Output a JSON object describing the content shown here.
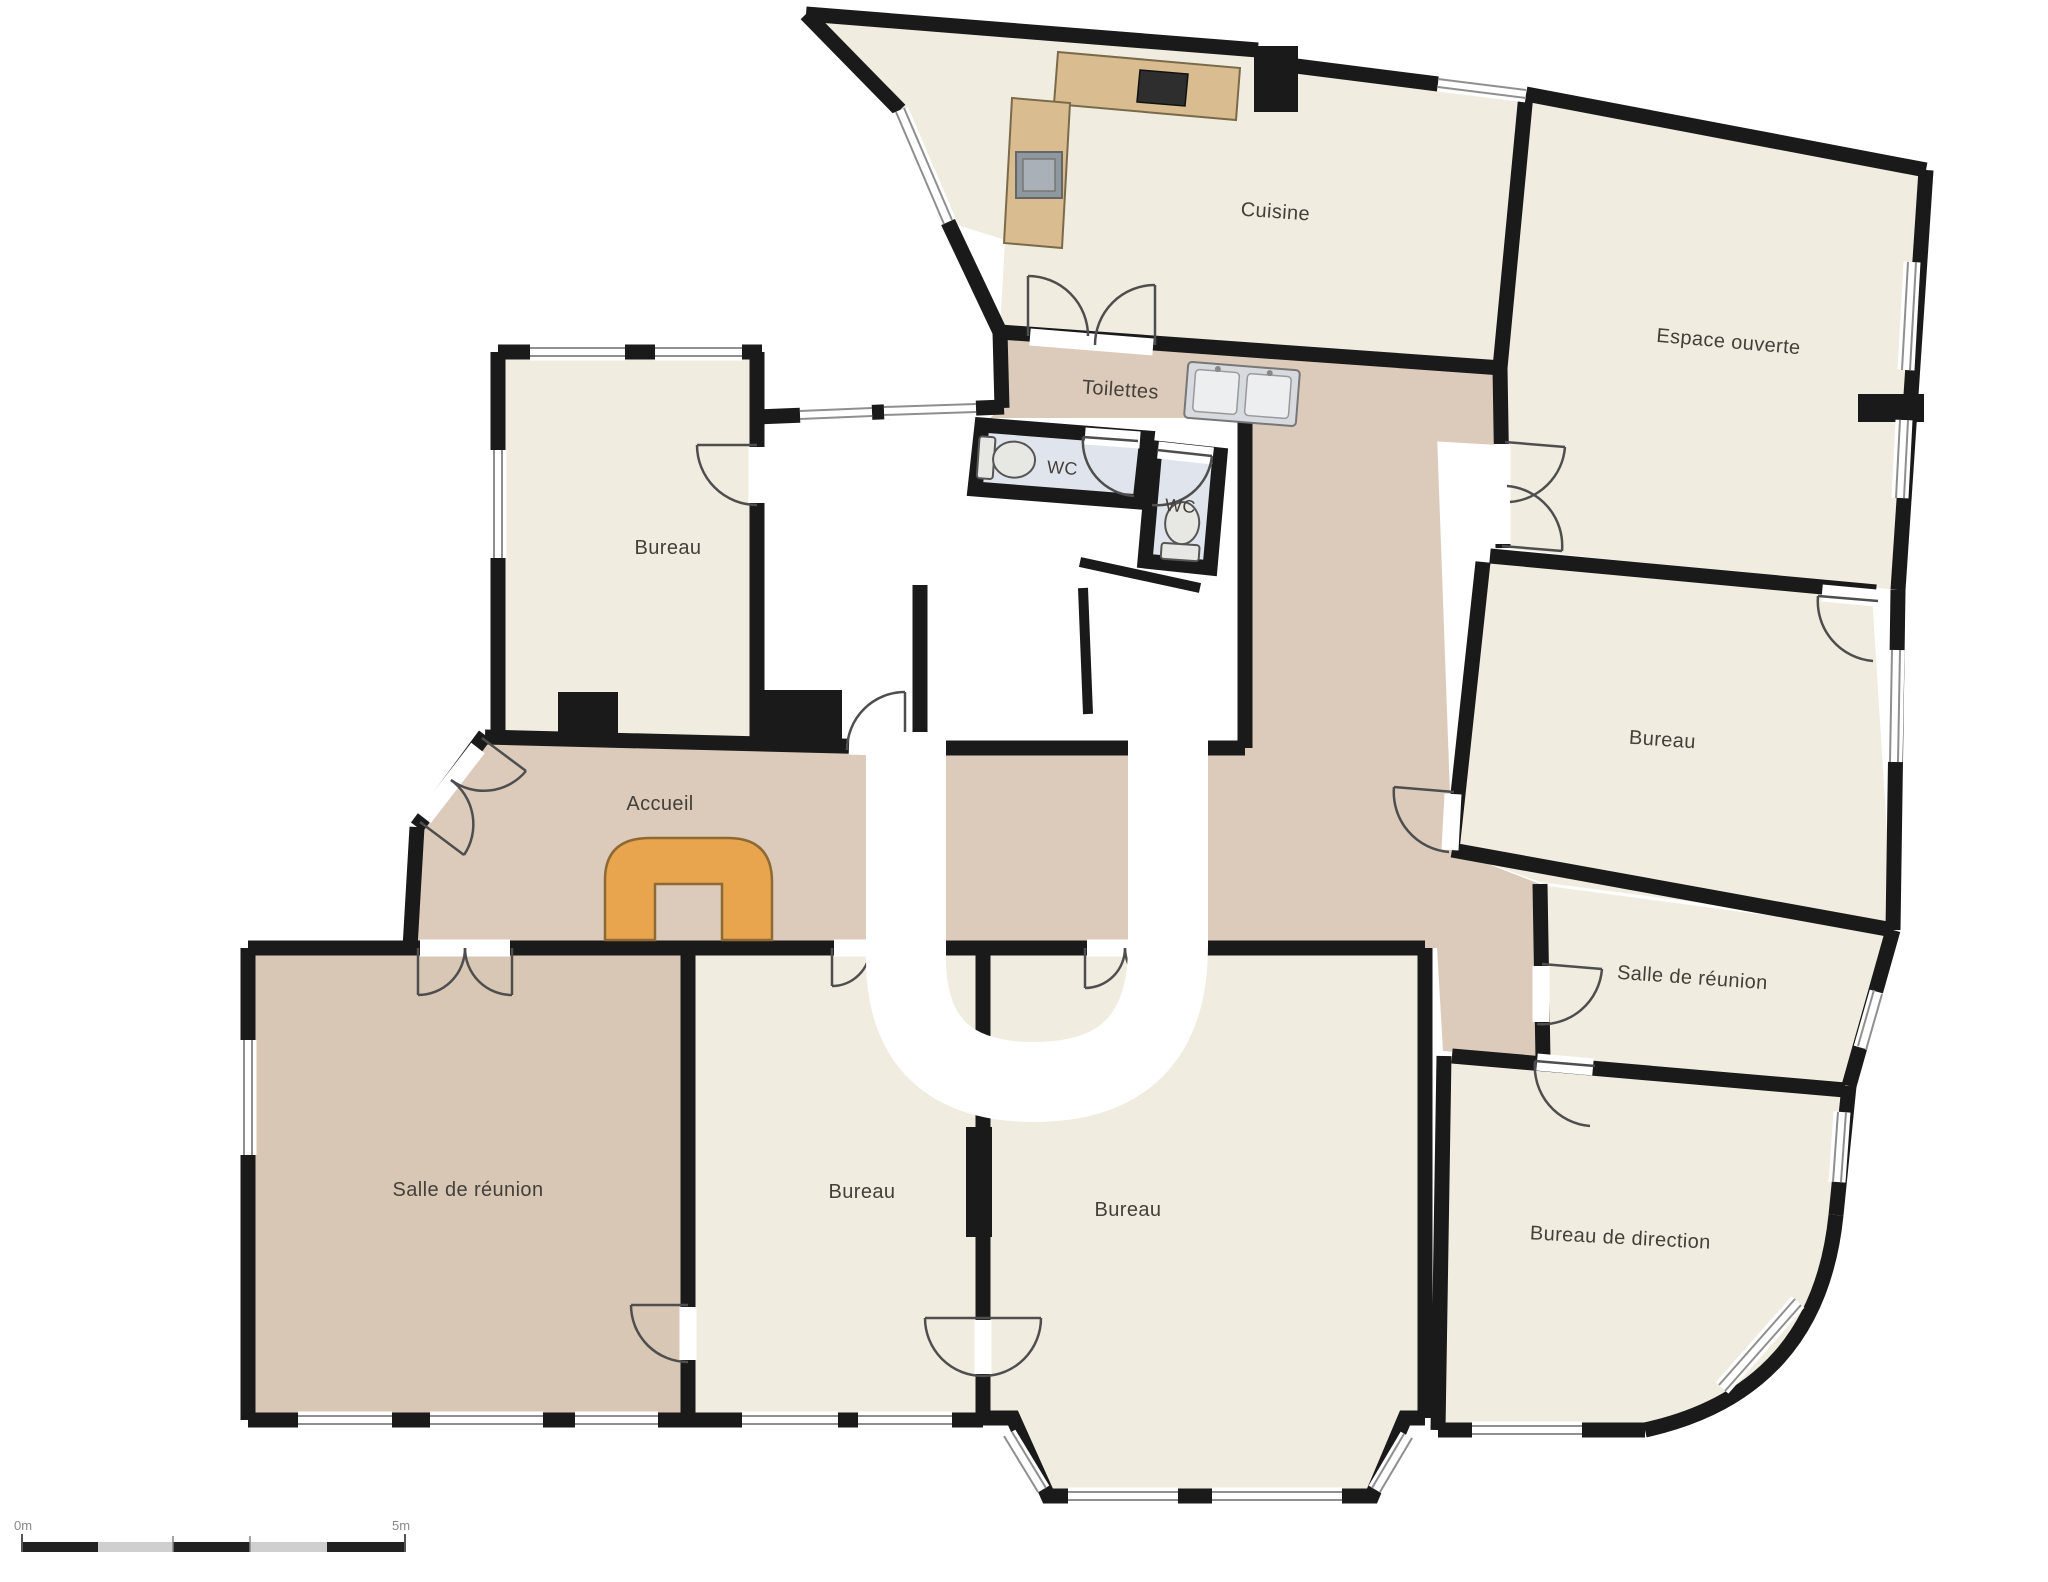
{
  "plan": {
    "rooms": [
      {
        "id": "cuisine",
        "label": "Cuisine"
      },
      {
        "id": "espace-ouverte",
        "label": "Espace ouverte"
      },
      {
        "id": "toilettes",
        "label": "Toilettes"
      },
      {
        "id": "wc-left",
        "label": "WC"
      },
      {
        "id": "wc-right",
        "label": "WC"
      },
      {
        "id": "bureau-top-left",
        "label": "Bureau"
      },
      {
        "id": "accueil",
        "label": "Accueil"
      },
      {
        "id": "bureau-right",
        "label": "Bureau"
      },
      {
        "id": "salle-reunion-right",
        "label": "Salle de réunion"
      },
      {
        "id": "salle-reunion-left",
        "label": "Salle de réunion"
      },
      {
        "id": "bureau-bottom-1",
        "label": "Bureau"
      },
      {
        "id": "bureau-bottom-2",
        "label": "Bureau"
      },
      {
        "id": "bureau-direction",
        "label": "Bureau de direction"
      }
    ],
    "scale_bar": {
      "start_label": "0m",
      "end_label": "5m",
      "segments": 5
    },
    "colors": {
      "room_fill": "#f0ecdf",
      "hall_fill": "#dccbbb",
      "meeting_fill": "#d9c7b6",
      "wc_fill": "#e0e4ec",
      "wall": "#1a1a1a",
      "counter": "#d9bc90",
      "desk": "#e9a54e",
      "watermark": "#ffffff"
    }
  }
}
